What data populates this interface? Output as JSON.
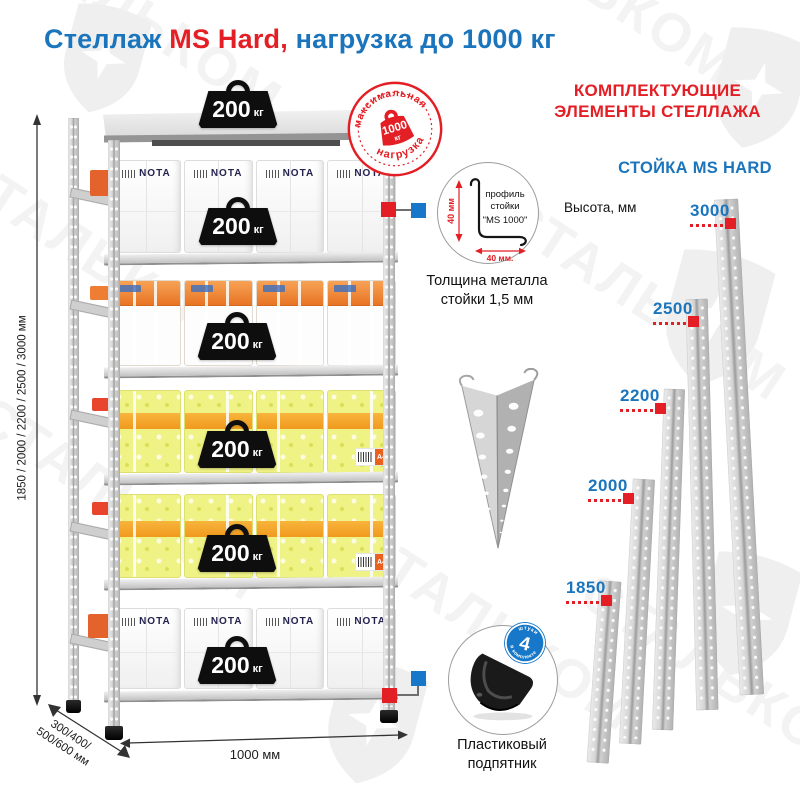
{
  "colors": {
    "blue": "#1B75BC",
    "red": "#E31E24",
    "badge_blue": "#1777C8"
  },
  "watermark": {
    "text": "СТАЛЬКОМ"
  },
  "title": {
    "prefix": "Стеллаж",
    "highlight": " MS Hard,",
    "suffix": " нагрузка до 1000 кг"
  },
  "rack": {
    "weight_value": "200",
    "weight_unit": "кг",
    "box_brand": "NOTA",
    "a4_label": "A4",
    "dim_height": "1850 / 2000 / 2200 / 2500 / 3000 мм",
    "dim_depth_line1": "300/400/",
    "dim_depth_line2": "500/600 мм",
    "dim_width": "1000 мм"
  },
  "max_load_badge": {
    "arc_top": "максимальная",
    "arc_bottom": "нагрузка",
    "value": "1000",
    "unit": "кг"
  },
  "profile_detail": {
    "line1": "профиль",
    "line2": "стойки",
    "line3": "\"MS 1000\"",
    "dim_v": "40 мм",
    "dim_h": "40 мм.",
    "caption_line1": "Толщина металла",
    "caption_line2": "стойки 1,5 мм"
  },
  "foot_detail": {
    "badge_value": "4",
    "badge_arc_top": "штуки",
    "badge_arc_bottom": "в комплекте",
    "caption_line1": "Пластиковый",
    "caption_line2": "подпятник"
  },
  "right_panel": {
    "header_line1": "КОМПЛЕКТУЮЩИЕ",
    "header_line2": "ЭЛЕМЕНТЫ СТЕЛЛАЖА",
    "subheader": "СТОЙКА MS HARD",
    "height_label": "Высота, мм",
    "posts": [
      {
        "height": "3000"
      },
      {
        "height": "2500"
      },
      {
        "height": "2200"
      },
      {
        "height": "2000"
      },
      {
        "height": "1850"
      }
    ]
  }
}
